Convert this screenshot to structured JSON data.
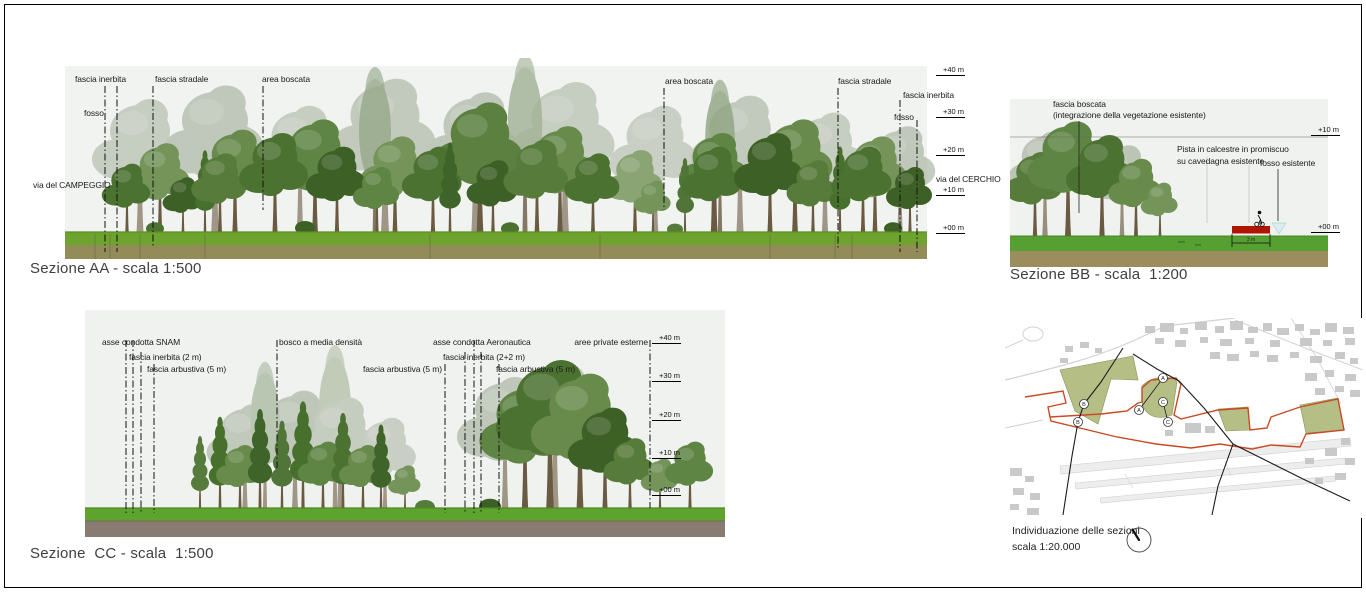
{
  "aa": {
    "title": "Sezione AA - scala 1:500",
    "labels": {
      "fascia_inerbita_left": "fascia inerbita",
      "fosso_left": "fosso",
      "fascia_stradale_left": "fascia stradale",
      "area_boscata_left": "area boscata",
      "via_campeggio": "via del CAMPEGGIO",
      "area_boscata_right": "area boscata",
      "fascia_stradale_right": "fascia stradale",
      "fascia_inerbita_right": "fascia inerbita",
      "fosso_right": "fosso",
      "via_cerchio": "via del CERCHIO"
    },
    "elevations": [
      "+40 m",
      "+30 m",
      "+20 m",
      "+10 m",
      "+00 m"
    ]
  },
  "bb": {
    "title": "Sezione BB - scala  1:200",
    "labels": {
      "fascia_boscata_1": "fascia boscata",
      "fascia_boscata_2": "(integrazione della vegetazione esistente)",
      "pista_1": "Pista in calcestre in promiscuo",
      "pista_2": "su cavedagna esistente",
      "fosso_esistente": "fosso esistente",
      "pista_width": "3 m"
    },
    "elevations": [
      "+10 m",
      "+00 m"
    ]
  },
  "cc": {
    "title": "Sezione  CC - scala  1:500",
    "labels": {
      "asse_snam": "asse condotta SNAM",
      "fascia_inerbita_2m": "fascia inerbita (2 m)",
      "fascia_arbustiva_left": "fascia arbustiva (5 m)",
      "bosco_media": "bosco a media densità",
      "fascia_arbustiva_mid": "fascia arbustiva (5 m)",
      "asse_aeronautica": "asse condotta Aeronautica",
      "fascia_inerbita_22": "fascia inerbita (2+2 m)",
      "fascia_arbustiva_right": "fascia arbustiva (5 m)",
      "aree_private": "aree private esterne"
    },
    "elevations": [
      "+40 m",
      "+30 m",
      "+20 m",
      "+10 m",
      "+00 m"
    ]
  },
  "map": {
    "caption_line1": "Individuazione delle sezioni",
    "caption_line2": "scala 1:20.000",
    "markers": [
      "A",
      "A",
      "C",
      "C",
      "B",
      "B"
    ]
  },
  "colors": {
    "pista_red": "#b01500",
    "map_boundary_red": "#c94a22",
    "map_green_fill": "#b5bf85",
    "fosso_marker_fill": "#d9edf0",
    "ground_green": "#6da32e",
    "ground_olive": "#918c58",
    "ground_brown": "#877b72"
  }
}
